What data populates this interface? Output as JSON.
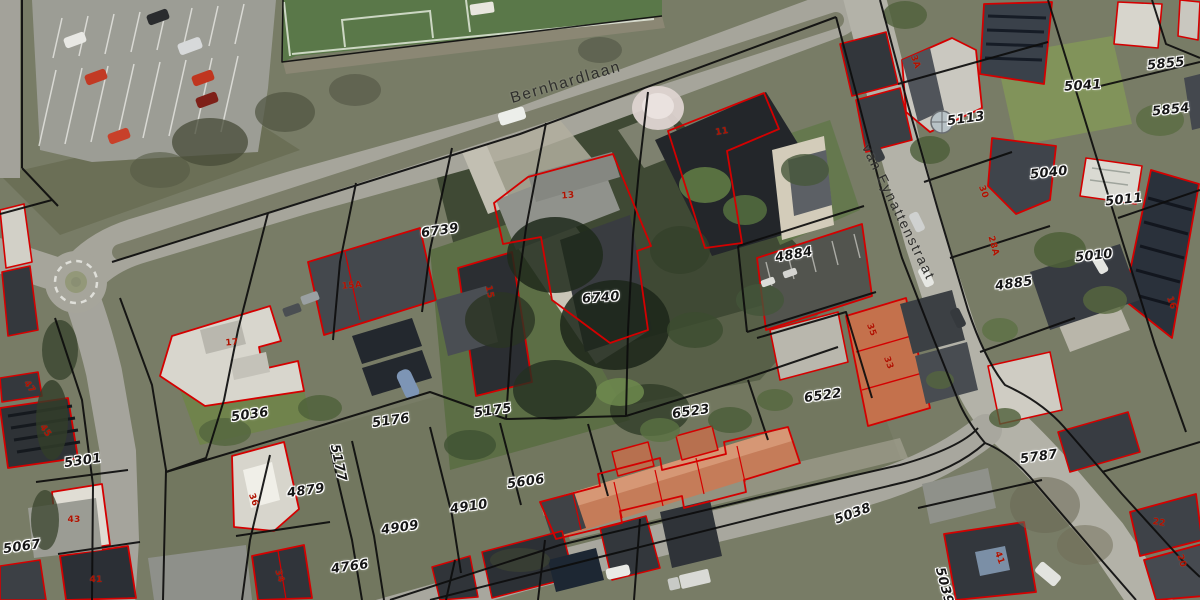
{
  "map": {
    "type": "aerial-cadastral-view",
    "colors": {
      "parcel_boundary_line": "#0d0d0d",
      "building_outline": "#d40000",
      "parcel_label_text": "#161616",
      "house_number_text": "#b01200",
      "street_label_text": "#2e2e2c"
    },
    "street_labels": [
      {
        "text": "Bernhardlaan",
        "x": 566,
        "y": 83,
        "rot": -16.5,
        "size": 15.5
      },
      {
        "text": "van Eynattenstraat",
        "x": 899,
        "y": 212,
        "rot": 64,
        "size": 14
      }
    ],
    "parcel_labels": [
      {
        "text": "6739",
        "x": 440,
        "y": 231,
        "rot": -8
      },
      {
        "text": "6740",
        "x": 601,
        "y": 298,
        "rot": -4
      },
      {
        "text": "4884",
        "x": 794,
        "y": 255,
        "rot": -10
      },
      {
        "text": "5041",
        "x": 1083,
        "y": 86,
        "rot": -4
      },
      {
        "text": "5113",
        "x": 966,
        "y": 119,
        "rot": -8
      },
      {
        "text": "5855",
        "x": 1166,
        "y": 64,
        "rot": -6
      },
      {
        "text": "5854",
        "x": 1171,
        "y": 110,
        "rot": -6
      },
      {
        "text": "5040",
        "x": 1049,
        "y": 173,
        "rot": -6
      },
      {
        "text": "5011",
        "x": 1124,
        "y": 200,
        "rot": -6
      },
      {
        "text": "5010",
        "x": 1094,
        "y": 256,
        "rot": -6
      },
      {
        "text": "4885",
        "x": 1014,
        "y": 284,
        "rot": -8
      },
      {
        "text": "5036",
        "x": 250,
        "y": 415,
        "rot": -8
      },
      {
        "text": "5176",
        "x": 391,
        "y": 421,
        "rot": -8
      },
      {
        "text": "5175",
        "x": 493,
        "y": 411,
        "rot": -8
      },
      {
        "text": "5177",
        "x": 338,
        "y": 463,
        "rot": 78
      },
      {
        "text": "4879",
        "x": 306,
        "y": 491,
        "rot": -8
      },
      {
        "text": "4909",
        "x": 400,
        "y": 528,
        "rot": -8
      },
      {
        "text": "4910",
        "x": 469,
        "y": 507,
        "rot": -8
      },
      {
        "text": "4766",
        "x": 350,
        "y": 567,
        "rot": -8
      },
      {
        "text": "5606",
        "x": 526,
        "y": 482,
        "rot": -8
      },
      {
        "text": "6523",
        "x": 691,
        "y": 412,
        "rot": -8
      },
      {
        "text": "6522",
        "x": 823,
        "y": 396,
        "rot": -8
      },
      {
        "text": "5301",
        "x": 83,
        "y": 461,
        "rot": -8
      },
      {
        "text": "5067",
        "x": 22,
        "y": 547,
        "rot": -8
      },
      {
        "text": "5787",
        "x": 1039,
        "y": 457,
        "rot": -8
      },
      {
        "text": "5038",
        "x": 853,
        "y": 514,
        "rot": -20
      },
      {
        "text": "5039",
        "x": 944,
        "y": 586,
        "rot": 75
      }
    ],
    "house_numbers": [
      {
        "text": "11",
        "x": 722,
        "y": 132,
        "rot": -10
      },
      {
        "text": "13",
        "x": 568,
        "y": 196,
        "rot": -5
      },
      {
        "text": "15",
        "x": 489,
        "y": 292,
        "rot": 78
      },
      {
        "text": "15A",
        "x": 352,
        "y": 286,
        "rot": -5
      },
      {
        "text": "17",
        "x": 232,
        "y": 343,
        "rot": -5
      },
      {
        "text": "36",
        "x": 253,
        "y": 500,
        "rot": 70
      },
      {
        "text": "34",
        "x": 279,
        "y": 576,
        "rot": 72
      },
      {
        "text": "45",
        "x": 45,
        "y": 431,
        "rot": 55
      },
      {
        "text": "43",
        "x": 74,
        "y": 520,
        "rot": 0
      },
      {
        "text": "47",
        "x": 29,
        "y": 387,
        "rot": 55
      },
      {
        "text": "41",
        "x": 96,
        "y": 580,
        "rot": 0
      },
      {
        "text": "35",
        "x": 871,
        "y": 330,
        "rot": 70
      },
      {
        "text": "33",
        "x": 888,
        "y": 363,
        "rot": 70
      },
      {
        "text": "30",
        "x": 983,
        "y": 192,
        "rot": 70
      },
      {
        "text": "28A",
        "x": 993,
        "y": 246,
        "rot": 75
      },
      {
        "text": "3A",
        "x": 915,
        "y": 62,
        "rot": 70
      },
      {
        "text": "16",
        "x": 1171,
        "y": 303,
        "rot": 70
      },
      {
        "text": "22",
        "x": 1159,
        "y": 523,
        "rot": 10
      },
      {
        "text": "20",
        "x": 1181,
        "y": 561,
        "rot": 72
      },
      {
        "text": "41",
        "x": 999,
        "y": 558,
        "rot": 70
      }
    ]
  }
}
